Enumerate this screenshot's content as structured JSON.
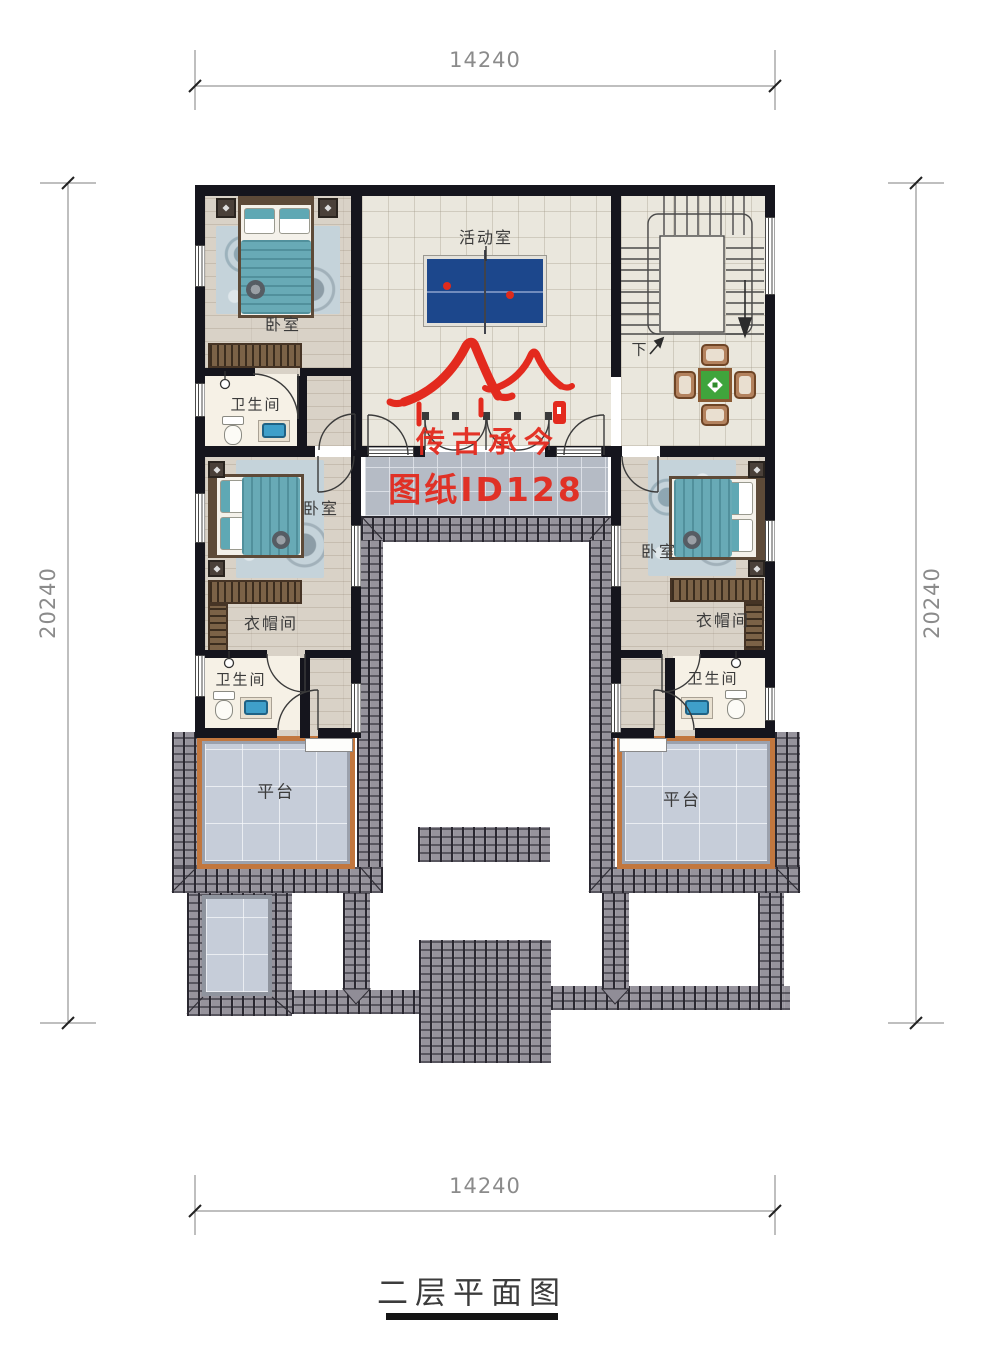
{
  "title": {
    "text": "二层平面图"
  },
  "dimensions": {
    "top": "14240",
    "bottom": "14240",
    "left": "20240",
    "right": "20240"
  },
  "watermark": {
    "brand": "传古承今",
    "sheet_id": "图纸ID128",
    "logo": "double-roof-icon"
  },
  "rooms": {
    "activity_room": "活动室",
    "bedroom_top_left": "卧室",
    "bathroom_top_left": "卫生间",
    "bedroom_left": "卧室",
    "cloakroom_left": "衣帽间",
    "bathroom_left": "卫生间",
    "bedroom_right": "卧室",
    "cloakroom_right": "衣帽间",
    "bathroom_right": "卫生间",
    "terrace_left": "平台",
    "terrace_right": "平台",
    "stair_down": "下"
  },
  "colors": {
    "wall": "#15151d",
    "roof_tile": "#96939c",
    "accent_red": "#e32a1e",
    "bed_teal": "#68aab6",
    "pingpong_blue": "#1c478c",
    "platform_border": "#c2773e",
    "table_green": "#3fa43c"
  }
}
